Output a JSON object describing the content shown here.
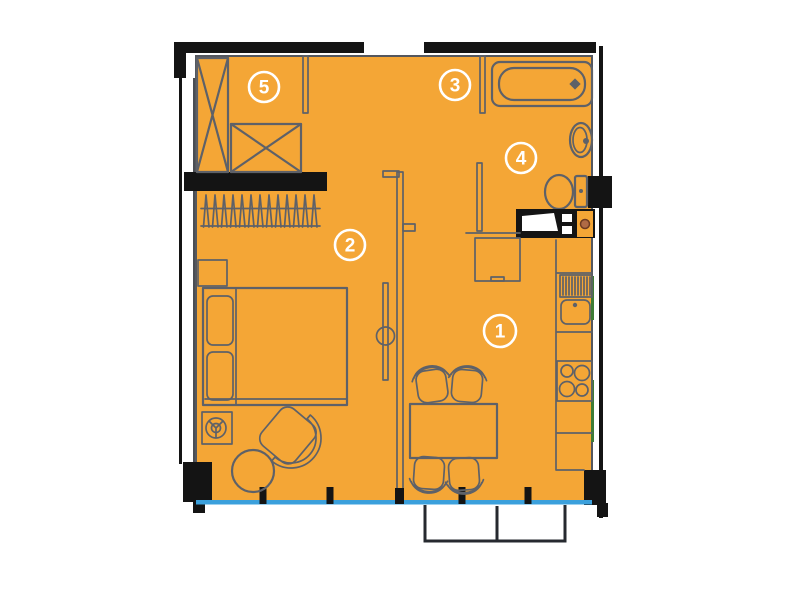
{
  "rooms": [
    {
      "number": "1"
    },
    {
      "number": "2"
    },
    {
      "number": "3"
    },
    {
      "number": "4"
    },
    {
      "number": "5"
    }
  ],
  "colors": {
    "floor_fill": "#F4A636",
    "furniture_line": "#5E6168",
    "wall_black": "#141414",
    "window_blue": "#3BA0DC",
    "window_green": "#3E7C35",
    "appliance_brown": "#B06A45",
    "background": "#FFFFFF"
  }
}
